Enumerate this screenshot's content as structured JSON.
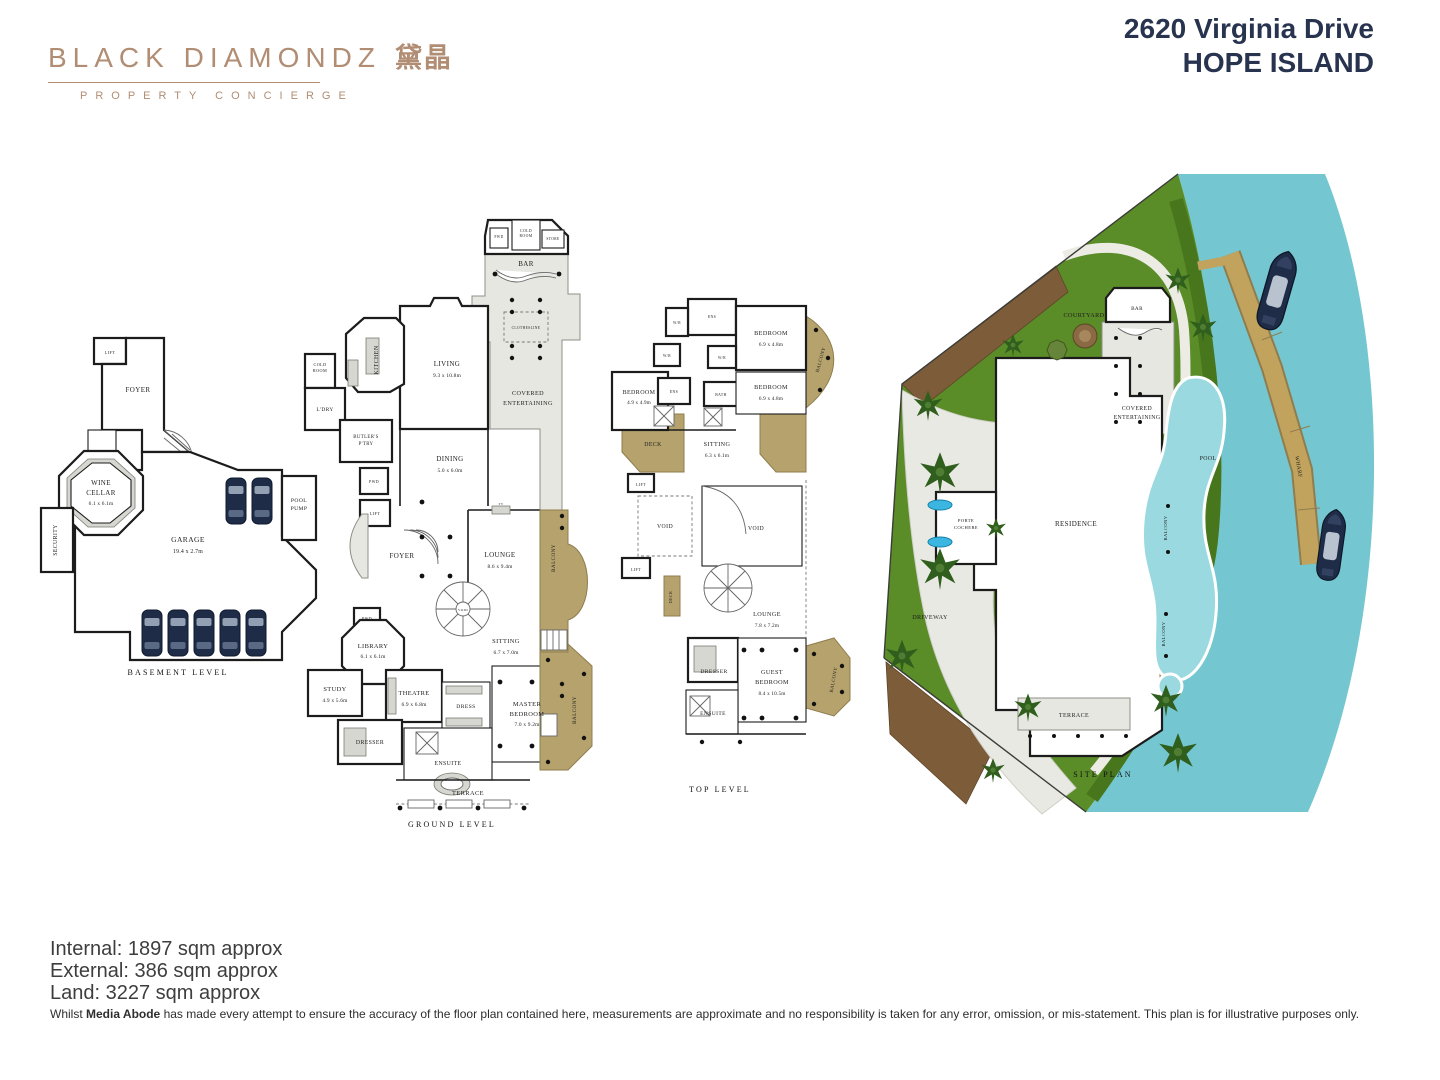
{
  "header": {
    "logo": {
      "brand": "BLACK DIAMONDZ",
      "cjk": "黛晶",
      "tagline": "PROPERTY CONCIERGE",
      "color": "#b18d74"
    },
    "address_line1": "2620 Virginia Drive",
    "address_line2": "HOPE ISLAND",
    "title_color": "#28344f"
  },
  "colors": {
    "walls": "#1c1c1c",
    "balcony_tan": "#b5a26c",
    "wharf_tan": "#c2a35e",
    "grass": "#5a8c28",
    "water": "#74c7d0",
    "pool": "#9ad9df",
    "mulch": "#7d5c3a",
    "car_navy": "#1e2c48",
    "covered_gray": "#e7e7e1"
  },
  "plans": [
    {
      "id": "basement",
      "labels": [
        {
          "t": "LIFT",
          "x": 72,
          "y": 24,
          "s": 4.2
        },
        {
          "t": "FOYER",
          "x": 100,
          "y": 62,
          "s": 7
        },
        {
          "t": "WINE",
          "x": 63,
          "y": 155,
          "s": 7
        },
        {
          "t": "CELLAR",
          "x": 63,
          "y": 165,
          "s": 7
        },
        {
          "t": "6.1 x 6.1m",
          "x": 63,
          "y": 175,
          "s": 5.3,
          "c": "dim"
        },
        {
          "t": "SECURITY",
          "x": 19,
          "y": 210,
          "s": 5.8,
          "r": -90
        },
        {
          "t": "GARAGE",
          "x": 150,
          "y": 212,
          "s": 7.5
        },
        {
          "t": "19.4 x 2.7m",
          "x": 150,
          "y": 223,
          "s": 5.8,
          "c": "dim"
        },
        {
          "t": "POOL",
          "x": 261,
          "y": 172,
          "s": 5.6
        },
        {
          "t": "PUMP",
          "x": 261,
          "y": 180,
          "s": 5.6
        },
        {
          "t": "BASEMENT LEVEL",
          "x": 140,
          "y": 345,
          "s": 8,
          "c": "cap",
          "n": "plan-caption"
        }
      ]
    },
    {
      "id": "ground",
      "labels": [
        {
          "t": "PWD",
          "x": 199,
          "y": 24,
          "s": 3.6
        },
        {
          "t": "COLD",
          "x": 226,
          "y": 18,
          "s": 3.8
        },
        {
          "t": "ROOM",
          "x": 226,
          "y": 23,
          "s": 3.8
        },
        {
          "t": "STORE",
          "x": 253,
          "y": 26,
          "s": 3.6
        },
        {
          "t": "BAR",
          "x": 226,
          "y": 52,
          "s": 7
        },
        {
          "t": "CLOTHESLINE",
          "x": 226,
          "y": 115,
          "s": 3.6
        },
        {
          "t": "COLD",
          "x": 20,
          "y": 152,
          "s": 4.2
        },
        {
          "t": "ROOM",
          "x": 20,
          "y": 158,
          "s": 4.2
        },
        {
          "t": "KITCHEN",
          "x": 78,
          "y": 146,
          "s": 6,
          "r": -90
        },
        {
          "t": "L'DRY",
          "x": 25,
          "y": 197,
          "s": 5.4
        },
        {
          "t": "BUTLER'S",
          "x": 66,
          "y": 224,
          "s": 4.8
        },
        {
          "t": "P'TRY",
          "x": 66,
          "y": 231,
          "s": 4.8
        },
        {
          "t": "LIVING",
          "x": 147,
          "y": 152,
          "s": 7
        },
        {
          "t": "9.3 x 10.8m",
          "x": 147,
          "y": 163,
          "s": 5.4,
          "c": "dim"
        },
        {
          "t": "COVERED",
          "x": 228,
          "y": 181,
          "s": 6.2
        },
        {
          "t": "ENTERTAINING",
          "x": 228,
          "y": 191,
          "s": 6.2
        },
        {
          "t": "DINING",
          "x": 150,
          "y": 247,
          "s": 7
        },
        {
          "t": "5.0 x 6.0m",
          "x": 150,
          "y": 258,
          "s": 5.4,
          "c": "dim"
        },
        {
          "t": "PWD",
          "x": 74,
          "y": 269,
          "s": 4
        },
        {
          "t": "LIFT",
          "x": 75,
          "y": 301,
          "s": 4.2
        },
        {
          "t": "FOYER",
          "x": 102,
          "y": 344,
          "s": 7
        },
        {
          "t": "TV",
          "x": 201,
          "y": 291,
          "s": 3.2
        },
        {
          "t": "LOUNGE",
          "x": 200,
          "y": 343,
          "s": 7
        },
        {
          "t": "8.6 x 9.4m",
          "x": 200,
          "y": 354,
          "s": 5.4,
          "c": "dim"
        },
        {
          "t": "BALCONY",
          "x": 255,
          "y": 344,
          "s": 5.2,
          "r": -90
        },
        {
          "t": "VOID",
          "x": 163,
          "y": 397,
          "s": 3.4
        },
        {
          "t": "PWD",
          "x": 67,
          "y": 406,
          "s": 4
        },
        {
          "t": "LIBRARY",
          "x": 73,
          "y": 434,
          "s": 6.4
        },
        {
          "t": "6.1 x 6.1m",
          "x": 73,
          "y": 444,
          "s": 5.4,
          "c": "dim"
        },
        {
          "t": "SITTING",
          "x": 206,
          "y": 429,
          "s": 6.4
        },
        {
          "t": "6.7 x 7.0m",
          "x": 206,
          "y": 440,
          "s": 5.4,
          "c": "dim"
        },
        {
          "t": "STUDY",
          "x": 35,
          "y": 477,
          "s": 6.4
        },
        {
          "t": "4.9 x 5.6m",
          "x": 35,
          "y": 488,
          "s": 5.4,
          "c": "dim"
        },
        {
          "t": "THEATRE",
          "x": 114,
          "y": 481,
          "s": 6.4
        },
        {
          "t": "6.9 x 6.8m",
          "x": 114,
          "y": 492,
          "s": 5.4,
          "c": "dim"
        },
        {
          "t": "DRESS",
          "x": 166,
          "y": 494,
          "s": 5.6
        },
        {
          "t": "MASTER",
          "x": 227,
          "y": 492,
          "s": 6.4
        },
        {
          "t": "BEDROOM",
          "x": 227,
          "y": 502,
          "s": 6.4
        },
        {
          "t": "7.0 x 9.2m",
          "x": 227,
          "y": 512,
          "s": 5.4,
          "c": "dim"
        },
        {
          "t": "DRESSER",
          "x": 70,
          "y": 530,
          "s": 5.8
        },
        {
          "t": "ENSUITE",
          "x": 148,
          "y": 551,
          "s": 5.8
        },
        {
          "t": "BALCONY",
          "x": 276,
          "y": 496,
          "s": 5.2,
          "r": -90
        },
        {
          "t": "TERRACE",
          "x": 168,
          "y": 581,
          "s": 6.4
        },
        {
          "t": "GROUND LEVEL",
          "x": 152,
          "y": 613,
          "s": 8,
          "c": "cap",
          "n": "plan-caption"
        }
      ]
    },
    {
      "id": "top",
      "labels": [
        {
          "t": "W/R",
          "x": 67,
          "y": 30,
          "s": 3.6
        },
        {
          "t": "ENS",
          "x": 102,
          "y": 24,
          "s": 3.8
        },
        {
          "t": "BEDROOM",
          "x": 161,
          "y": 41,
          "s": 6.2
        },
        {
          "t": "6.9 x 4.8m",
          "x": 161,
          "y": 52,
          "s": 5.2,
          "c": "dim"
        },
        {
          "t": "BALCONY",
          "x": 212,
          "y": 66,
          "s": 4.8,
          "r": -75
        },
        {
          "t": "W/R",
          "x": 57,
          "y": 63,
          "s": 3.6
        },
        {
          "t": "W/R",
          "x": 112,
          "y": 65,
          "s": 3.6
        },
        {
          "t": "BEDROOM",
          "x": 29,
          "y": 100,
          "s": 6
        },
        {
          "t": "4.9 x 4.9m",
          "x": 29,
          "y": 110,
          "s": 5.1,
          "c": "dim"
        },
        {
          "t": "ENS",
          "x": 64,
          "y": 99,
          "s": 3.8
        },
        {
          "t": "BATH",
          "x": 111,
          "y": 102,
          "s": 3.8
        },
        {
          "t": "BEDROOM",
          "x": 161,
          "y": 95,
          "s": 6.2
        },
        {
          "t": "6.9 x 4.8m",
          "x": 161,
          "y": 106,
          "s": 5.2,
          "c": "dim"
        },
        {
          "t": "DECK",
          "x": 43,
          "y": 152,
          "s": 5.8
        },
        {
          "t": "SITTING",
          "x": 107,
          "y": 152,
          "s": 6.2
        },
        {
          "t": "6.3 x 6.1m",
          "x": 107,
          "y": 163,
          "s": 5.2,
          "c": "dim"
        },
        {
          "t": "LIFT",
          "x": 31,
          "y": 192,
          "s": 4
        },
        {
          "t": "VOID",
          "x": 55,
          "y": 234,
          "s": 5.8
        },
        {
          "t": "VOID",
          "x": 146,
          "y": 236,
          "s": 5.8
        },
        {
          "t": "LIFT",
          "x": 26,
          "y": 277,
          "s": 4
        },
        {
          "t": "DECK",
          "x": 62,
          "y": 303,
          "s": 4,
          "r": -90
        },
        {
          "t": "LOUNGE",
          "x": 157,
          "y": 322,
          "s": 6.2
        },
        {
          "t": "7.8 x 7.2m",
          "x": 157,
          "y": 333,
          "s": 5.2,
          "c": "dim"
        },
        {
          "t": "DRESSER",
          "x": 104,
          "y": 379,
          "s": 5.6
        },
        {
          "t": "GUEST",
          "x": 162,
          "y": 380,
          "s": 6.2
        },
        {
          "t": "BEDROOM",
          "x": 162,
          "y": 390,
          "s": 6.2
        },
        {
          "t": "8.4 x 10.5m",
          "x": 162,
          "y": 401,
          "s": 5.2,
          "c": "dim"
        },
        {
          "t": "ENSUITE",
          "x": 103,
          "y": 421,
          "s": 5.5
        },
        {
          "t": "BALCONY",
          "x": 225,
          "y": 386,
          "s": 4.8,
          "r": -80
        },
        {
          "t": "TOP LEVEL",
          "x": 110,
          "y": 498,
          "s": 8,
          "c": "cap",
          "n": "plan-caption"
        }
      ]
    },
    {
      "id": "site",
      "labels": [
        {
          "t": "COURTYARD",
          "x": 206,
          "y": 147,
          "s": 6.2
        },
        {
          "t": "BAR",
          "x": 259,
          "y": 140,
          "s": 5.2
        },
        {
          "t": "COVERED",
          "x": 259,
          "y": 240,
          "s": 5.8
        },
        {
          "t": "ENTERTAINING",
          "x": 259,
          "y": 249,
          "s": 5.8
        },
        {
          "t": "RESIDENCE",
          "x": 198,
          "y": 356,
          "s": 7
        },
        {
          "t": "PORTE",
          "x": 88,
          "y": 352,
          "s": 4.6
        },
        {
          "t": "COCHERE",
          "x": 88,
          "y": 359,
          "s": 4.6
        },
        {
          "t": "BALCONY",
          "x": 289,
          "y": 358,
          "s": 4.6,
          "r": -90
        },
        {
          "t": "BALCONY",
          "x": 287,
          "y": 464,
          "s": 4.6,
          "r": -90
        },
        {
          "t": "DRIVEWAY",
          "x": 52,
          "y": 449,
          "s": 6.2
        },
        {
          "t": "POOL",
          "x": 330,
          "y": 290,
          "s": 5.8
        },
        {
          "t": "WHARF",
          "x": 419,
          "y": 297,
          "s": 5.5,
          "r": 80
        },
        {
          "t": "TERRACE",
          "x": 196,
          "y": 547,
          "s": 6
        },
        {
          "t": "SITE PLAN",
          "x": 225,
          "y": 607,
          "s": 8,
          "c": "cap",
          "n": "plan-caption"
        }
      ]
    }
  ],
  "footer": {
    "areas": [
      "Internal: 1897 sqm approx",
      "External: 386 sqm approx",
      "Land: 3227 sqm approx"
    ],
    "disclaimer_prefix": "Whilst ",
    "disclaimer_bold": "Media Abode",
    "disclaimer_rest": " has made every attempt to ensure the accuracy of the floor plan contained here, measurements are approximate and no responsibility is taken for any error, omission, or mis-statement. This plan is for illustrative purposes only."
  }
}
